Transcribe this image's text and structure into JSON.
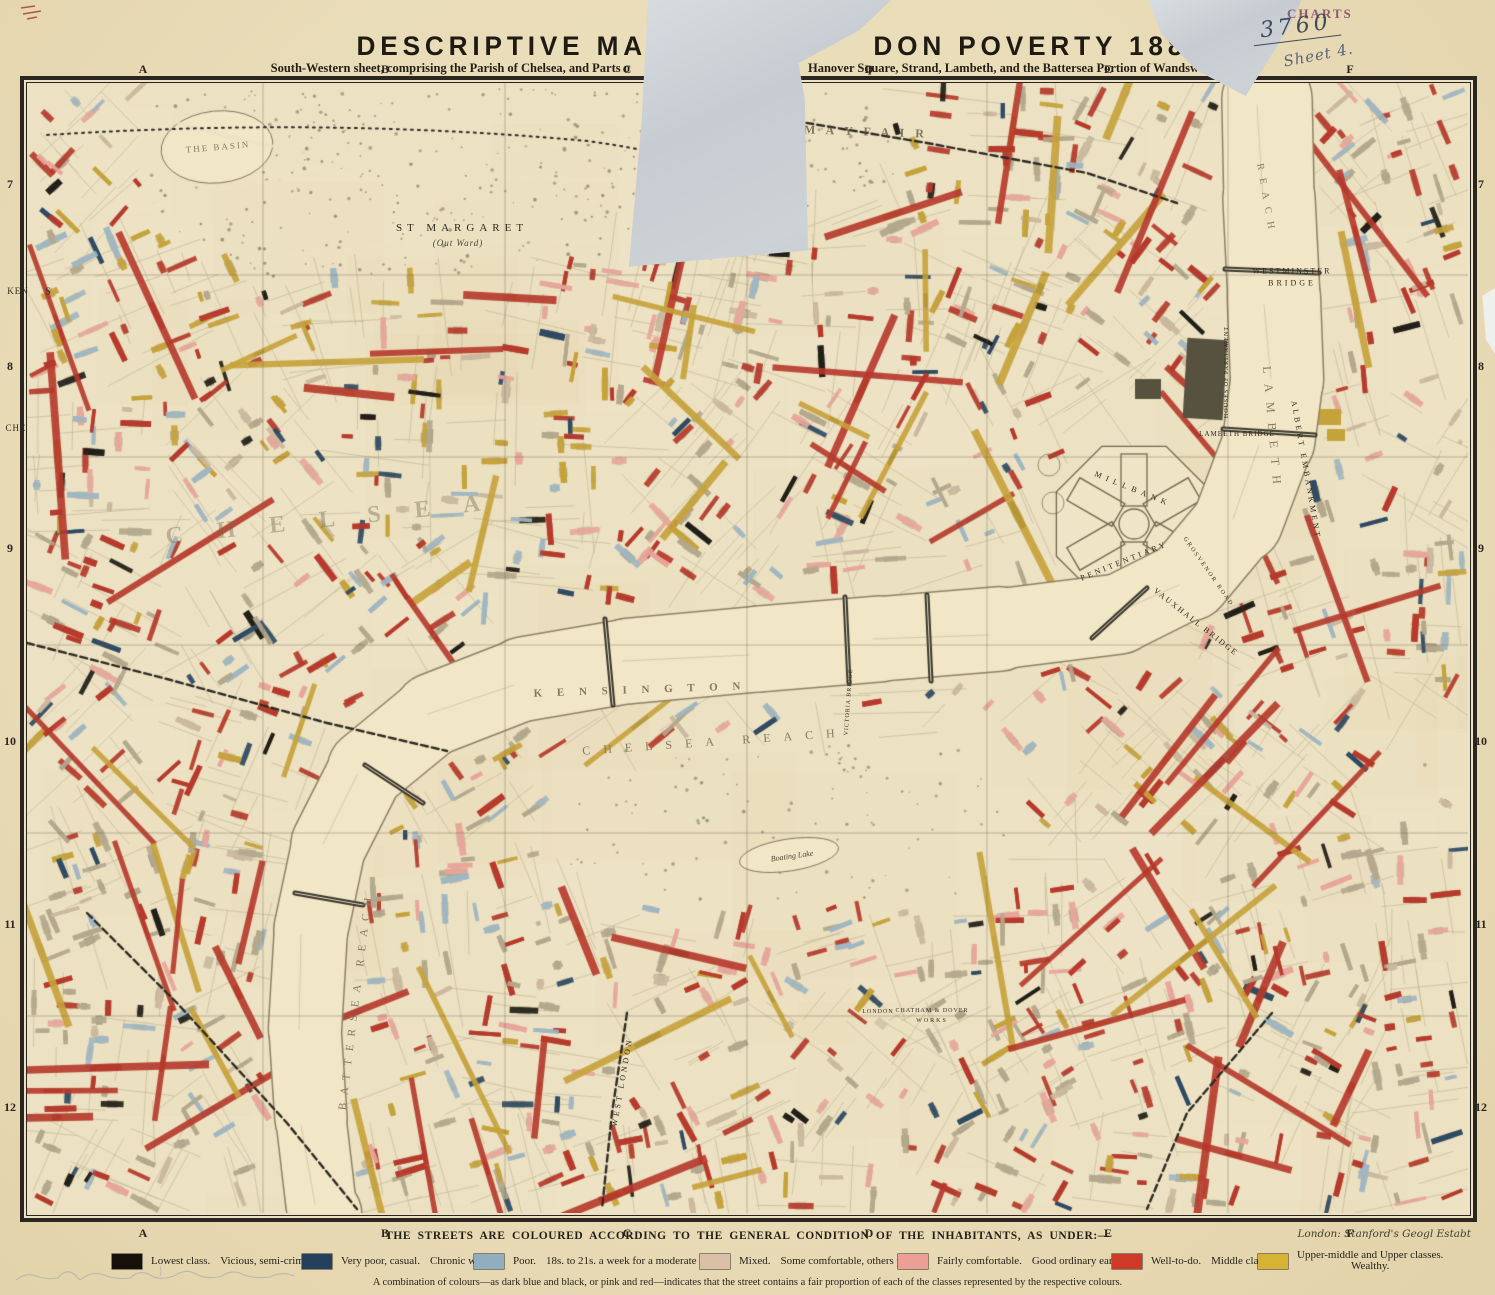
{
  "header": {
    "title_left": "DESCRIPTIVE MA",
    "title_right": "DON POVERTY 1889.",
    "subtitle_left": "South-Western sheet, comprising the Parish of Chelsea, and Parts o",
    "subtitle_right": "Hanover Square, Strand, Lambeth, and the Battersea Portion of Wandsworth."
  },
  "stamp": {
    "label": "CHARTS",
    "number": "3760",
    "sheet_note": "Sheet 4."
  },
  "imprint": "London: Stanford's Geogl Estabt",
  "grid": {
    "columns": [
      "A",
      "B",
      "C",
      "D",
      "E",
      "F"
    ],
    "rows": [
      "7",
      "8",
      "9",
      "10",
      "11",
      "12"
    ],
    "col_x": [
      143,
      385,
      627,
      869,
      1108,
      1350
    ],
    "row_y": [
      185,
      367,
      549,
      742,
      925,
      1108
    ]
  },
  "legend": {
    "caption": "THE STREETS ARE COLOURED ACCORDING TO THE GENERAL CONDITION OF THE INHABITANTS, AS UNDER:—",
    "note": "A combination of colours—as dark blue and black, or pink and red—indicates that the street contains a fair proportion of each of the classes represented by the respective colours.",
    "items": [
      {
        "color": "#17100b",
        "label": "Lowest class.",
        "sublabel": "Vicious, semi-criminal."
      },
      {
        "color": "#23405c",
        "label": "Very poor, casual.",
        "sublabel": "Chronic want."
      },
      {
        "color": "#91aec0",
        "label": "Poor.",
        "sublabel": "18s. to 21s. a week for a moderate family."
      },
      {
        "color": "#d9c0a7",
        "label": "Mixed.",
        "sublabel": "Some comfortable, others poor."
      },
      {
        "color": "#ec9f96",
        "label": "Fairly comfortable.",
        "sublabel": "Good ordinary earnings."
      },
      {
        "color": "#cf3a28",
        "label": "Well-to-do.",
        "sublabel": "Middle class."
      },
      {
        "color": "#d6b335",
        "label": "Upper-middle and Upper classes.",
        "sublabel": "Wealthy."
      }
    ]
  },
  "map": {
    "labels": [
      {
        "text": "THE BASIN",
        "x": 218,
        "y": 147,
        "size": 9,
        "ls": 2,
        "rot": -5,
        "style": "river"
      },
      {
        "text": "ST MARGARET",
        "x": 462,
        "y": 228,
        "size": 11,
        "ls": 5,
        "rot": 0,
        "style": "plain"
      },
      {
        "text": "(Out Ward)",
        "x": 458,
        "y": 243,
        "size": 9,
        "ls": 1,
        "rot": 0,
        "style": "italic"
      },
      {
        "text": "WESTMINSTER",
        "x": 1292,
        "y": 271,
        "size": 8,
        "ls": 2,
        "rot": 0,
        "style": "plain"
      },
      {
        "text": "BRIDGE",
        "x": 1292,
        "y": 283,
        "size": 8,
        "ls": 3,
        "rot": 0,
        "style": "plain"
      },
      {
        "text": "HOUSES OF PARLIAMENT",
        "x": 1227,
        "y": 372,
        "size": 6,
        "ls": 1,
        "rot": -90,
        "style": "plain"
      },
      {
        "text": "REACH",
        "x": 1266,
        "y": 200,
        "size": 10,
        "ls": 8,
        "rot": 80,
        "style": "river"
      },
      {
        "text": "LAMBETH",
        "x": 1272,
        "y": 430,
        "size": 12,
        "ls": 10,
        "rot": 85,
        "style": "river"
      },
      {
        "text": "ALBERT EMBANKMENT",
        "x": 1306,
        "y": 470,
        "size": 8,
        "ls": 3,
        "rot": 80,
        "style": "plain"
      },
      {
        "text": "LAMBETH BRIDGE",
        "x": 1237,
        "y": 434,
        "size": 7,
        "ls": 1,
        "rot": 0,
        "style": "plain"
      },
      {
        "text": "VAUXHALL BRIDGE",
        "x": 1196,
        "y": 622,
        "size": 8,
        "ls": 2,
        "rot": 38,
        "style": "plain"
      },
      {
        "text": "MILLBANK",
        "x": 1133,
        "y": 489,
        "size": 8,
        "ls": 5,
        "rot": 22,
        "style": "plain"
      },
      {
        "text": "PENITENTIARY",
        "x": 1124,
        "y": 561,
        "size": 8,
        "ls": 3,
        "rot": -22,
        "style": "plain"
      },
      {
        "text": "GROSVENOR ROAD",
        "x": 1208,
        "y": 572,
        "size": 6,
        "ls": 2,
        "rot": 55,
        "style": "plain"
      },
      {
        "text": "CHELSEA REACH",
        "x": 715,
        "y": 742,
        "size": 12,
        "ls": 13,
        "rot": -4,
        "style": "river"
      },
      {
        "text": "BATTERSEA REACH",
        "x": 356,
        "y": 1000,
        "size": 11,
        "ls": 8,
        "rot": -83,
        "style": "river"
      },
      {
        "text": "Boating Lake",
        "x": 792,
        "y": 856,
        "size": 8,
        "ls": 0,
        "rot": -8,
        "style": "italic"
      },
      {
        "text": "VICTORIA BRIDGE",
        "x": 849,
        "y": 702,
        "size": 6,
        "ls": 1,
        "rot": -86,
        "style": "plain"
      },
      {
        "text": "WEST LONDON",
        "x": 622,
        "y": 1082,
        "size": 8,
        "ls": 3,
        "rot": -80,
        "style": "plain"
      },
      {
        "text": "LONDON",
        "x": 878,
        "y": 1012,
        "size": 6,
        "ls": 1,
        "rot": 0,
        "style": "plain"
      },
      {
        "text": "CHATHAM & DOVER",
        "x": 932,
        "y": 1011,
        "size": 6,
        "ls": 1,
        "rot": 0,
        "style": "plain"
      },
      {
        "text": "WORKS",
        "x": 932,
        "y": 1021,
        "size": 6,
        "ls": 2,
        "rot": 0,
        "style": "plain"
      },
      {
        "text": "A",
        "x": 672,
        "y": 128,
        "size": 58,
        "ls": 0,
        "rot": 0,
        "style": "ghost"
      },
      {
        "text": "M A Y F A I R",
        "x": 866,
        "y": 132,
        "size": 12,
        "ls": 4,
        "rot": 2,
        "style": "ghost2"
      },
      {
        "text": "K E N S I N G T O N",
        "x": 640,
        "y": 690,
        "size": 11,
        "ls": 6,
        "rot": -2,
        "style": "ghost2"
      },
      {
        "text": "C H E L S E A",
        "x": 330,
        "y": 520,
        "size": 24,
        "ls": 14,
        "rot": -6,
        "style": "ghost"
      },
      {
        "text": "KEN",
        "x": 18,
        "y": 291,
        "size": 9,
        "ls": 1,
        "rot": 0,
        "style": "plain"
      },
      {
        "text": "S",
        "x": 48,
        "y": 292,
        "size": 10,
        "ls": 0,
        "rot": 0,
        "style": "plain"
      },
      {
        "text": "CHE",
        "x": 16,
        "y": 428,
        "size": 9,
        "ls": 1,
        "rot": 0,
        "style": "plain"
      }
    ]
  },
  "palette": {
    "paper": "#e9dcb8",
    "map_paper": "#ece2c3",
    "border": "#2b2620",
    "river": "#f1e7c7",
    "river_bank": "#8d8165",
    "street_red": "#b6392b",
    "street_pink": "#e8a69b",
    "street_gold": "#c6a23a",
    "street_lightblue": "#9fb6c2",
    "street_darkblue": "#2f4a63",
    "street_black": "#221e18",
    "street_tan": "#cbb9a0",
    "building_gray": "#b3a88d"
  }
}
